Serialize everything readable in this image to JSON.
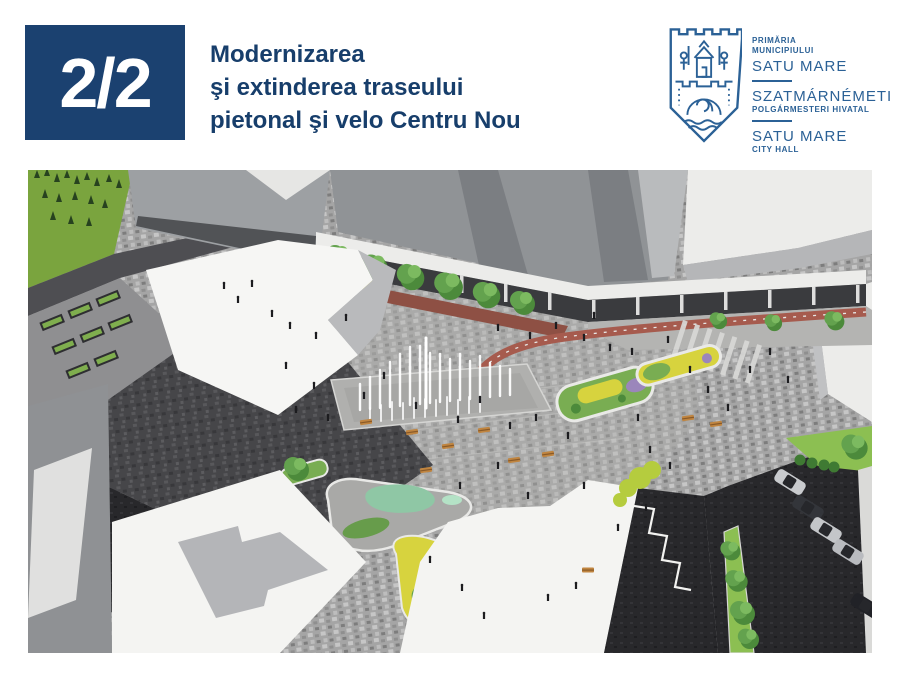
{
  "slide": {
    "badge_label": "2/2",
    "title_lines": [
      "Modernizarea",
      "şi extinderea traseului",
      "pietonal şi velo Centru Nou"
    ]
  },
  "logo": {
    "line1": "PRIMĂRIA",
    "line2": "MUNICIPIULUI",
    "name_ro": "SATU MARE",
    "name_hu": "SZATMÁRNÉMETI",
    "sub_hu": "POLGÁRMESTERI HIVATAL",
    "name_en": "SATU MARE",
    "sub_en": "CITY HALL"
  },
  "illustration": {
    "alt": "Aerial architectural rendering of the modernized New Centre pedestrian and cycling plaza: dry-deck fountain with water jets, speckled paving, planted islands with yellow and purple flowers, rows of trees along a colonnade, red bike lane, benches, pedestrians, white buildings and a car park"
  },
  "colors": {
    "badge_bg": "#1b4170",
    "title_text": "#173e6b",
    "logo_blue": "#2b6196"
  }
}
